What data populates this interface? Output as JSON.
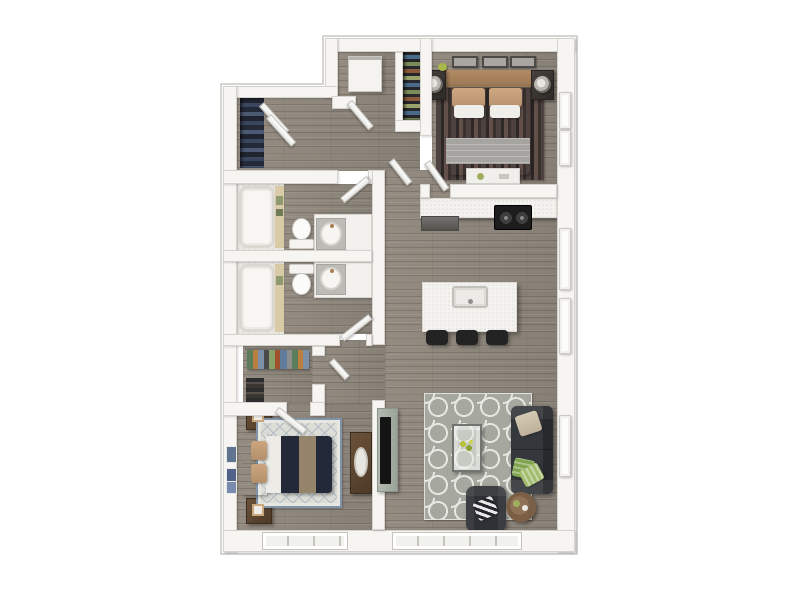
{
  "floor_plan": {
    "type": "apartment-unit-3d-top-down-render",
    "bedrooms": 2,
    "bathrooms": 2,
    "rooms": [
      {
        "id": "bedroom-1",
        "label": "Bedroom 1 (top right)",
        "furniture": [
          "queen-bed-white-duvet-gray-blanket",
          "tan-accent-pillows",
          "headboard-tan",
          "nightstand-left-with-lamp",
          "nightstand-right-with-lamp",
          "three-wall-frames-above-bed",
          "dark-striped-area-rug",
          "white-dresser-south-wall",
          "sliding-closet-panels-right-wall"
        ]
      },
      {
        "id": "laundry-utility",
        "label": "Laundry / utility room (top center)",
        "furniture": [
          "stacked-washer-dryer"
        ]
      },
      {
        "id": "entry-shoe-closet",
        "label": "Shoe/coat shelving closet (top center-right)",
        "furniture": [
          "shelves-with-colorful-shoes"
        ]
      },
      {
        "id": "hallway",
        "label": "Hallway (upper left)",
        "furniture": [
          "linen-closet-with-folded-dark-clothes",
          "open-double-doors"
        ]
      },
      {
        "id": "bathroom-1",
        "label": "Bathroom 1 (middle left, upper)",
        "furniture": [
          "bathtub-with-tan-trim-and-green-towels",
          "toilet",
          "vanity-with-oval-sink"
        ]
      },
      {
        "id": "bathroom-2",
        "label": "Bathroom 2 (middle left, lower)",
        "furniture": [
          "bathtub-with-tan-trim",
          "toilet",
          "vanity-with-oval-sink"
        ]
      },
      {
        "id": "walk-in-closet",
        "label": "Walk-in closet (left, above bedroom 2)",
        "furniture": [
          "hanging-rod-with-colorful-clothes",
          "shoe-stack"
        ]
      },
      {
        "id": "bedroom-2",
        "label": "Bedroom 2 (bottom left)",
        "furniture": [
          "bed-navy-duvet-tan-runner",
          "white-upholstered-headboard",
          "tan-pillows",
          "diamond-lattice-rug-blue-border",
          "nightstand-top-with-photo",
          "nightstand-bottom-with-photo",
          "dresser-with-oval-mirror",
          "two-blue-wall-art-pieces"
        ]
      },
      {
        "id": "kitchen",
        "label": "Kitchen (center right)",
        "furniture": [
          "counter-run-top-wall",
          "black-range-two-burners",
          "dark-base-appliance",
          "quartz-island-with-sink-and-faucet",
          "three-black-bar-stools"
        ]
      },
      {
        "id": "living-room",
        "label": "Living room (bottom right)",
        "furniture": [
          "gray-quatrefoil-trellis-rug",
          "charcoal-sofa",
          "tan-throw-pillow",
          "two-green-throw-pillows",
          "glass-coffee-table-with-greenery",
          "charcoal-armchair",
          "black-white-striped-pillow",
          "round-wood-side-table",
          "tv-on-panel-facing-living-room"
        ]
      }
    ],
    "doors": [
      "entry-door-laundry",
      "hall-closet-double-doors",
      "hall-to-great-room-door",
      "bedroom-1-door",
      "bathroom-1-door",
      "bathroom-2-door",
      "walk-in-closet-door",
      "bedroom-2-door"
    ],
    "windows": [
      "bedroom-1-right-wall-double",
      "kitchen-right-wall-upper",
      "kitchen-right-wall-lower",
      "living-room-right-wall",
      "bedroom-2-bottom-window",
      "living-room-bottom-window"
    ]
  },
  "colors": {
    "background": "#ffffff",
    "wall": "#f6f5f2",
    "wall_edge": "#d6d3cf",
    "outline": "#c9c7c3",
    "floor": "#8f887d",
    "counter": "#f3f2ee",
    "stove": "#1d1d1d",
    "stool": "#232323",
    "sofa": "#34373b",
    "armchair": "#2e3135",
    "rug_living": "#a6a89f",
    "rug_living_pattern": "#e8e8e2",
    "rug_bed2": "#dcddd6",
    "rug_bed2_border": "#7f93a9",
    "duvet_navy": "#232938",
    "runner_tan": "#95836c",
    "pillow_tan": "#c5a07c",
    "headboard_tan": "#a8835f",
    "bedding_white": "#edebe6",
    "blanket_gray": "#a5a4a0",
    "rug_bed1_dark": "#4e4240",
    "wood_furniture": "#5d4430",
    "nightstand_dark": "#3a3633",
    "tv_board": "#aab3a9",
    "tv_screen": "#141414",
    "green_accent": "#94b35c",
    "towel_green": "#8f9a72",
    "tub": "#f7f6f3",
    "tub_trim": "#d9cba6",
    "panel_room": "#e9e8e3",
    "closet_dark": "#20242c"
  }
}
